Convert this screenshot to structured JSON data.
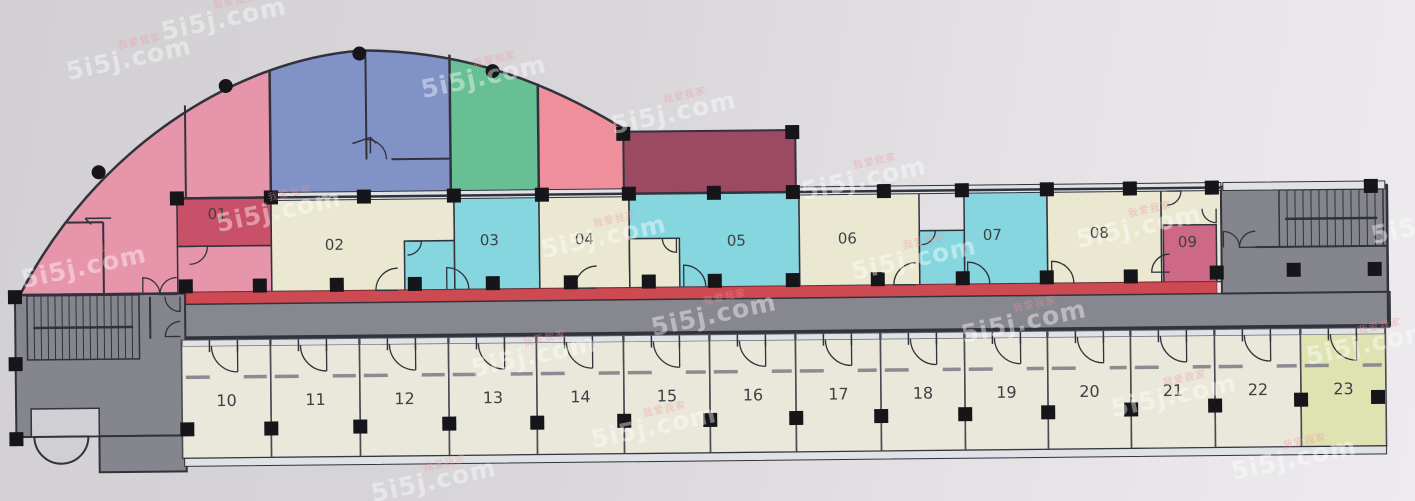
{
  "watermark": {
    "brand": "5i5j.com",
    "cn": "我爱我家",
    "positions": [
      [
        20,
        252
      ],
      [
        65,
        44
      ],
      [
        160,
        4
      ],
      [
        215,
        196
      ],
      [
        420,
        62
      ],
      [
        610,
        98
      ],
      [
        540,
        222
      ],
      [
        800,
        164
      ],
      [
        850,
        244
      ],
      [
        1075,
        212
      ],
      [
        1370,
        208
      ],
      [
        650,
        300
      ],
      [
        960,
        307
      ],
      [
        1305,
        329
      ],
      [
        470,
        341
      ],
      [
        590,
        412
      ],
      [
        1110,
        381
      ],
      [
        370,
        466
      ],
      [
        1230,
        444
      ]
    ]
  },
  "plan": {
    "palette": {
      "pink": "#e795ab",
      "red": "#c85068",
      "blue": "#8092c6",
      "green": "#67c093",
      "salmon": "#ee8f9b",
      "maroon": "#9c4a62",
      "cream": "#eae8d0",
      "cyan": "#85d6de",
      "deepPink": "#cd6886",
      "redStrip": "#ce4a52",
      "gray": "#87878f",
      "blockGray": "#85858e",
      "roomFill": "#e9e8da",
      "room23": "#dfe3b2",
      "window": "#dfe3e6",
      "wall": "#32323c",
      "column": "#15151a",
      "label": "#3f4046",
      "lightFill": "#d0d0d4"
    },
    "arc": {
      "path": "M20,288 L186,288 L186,193 L630,193 L630,131 C555,83 470,48 365,47 C235,55 95,145 20,288 Z",
      "bands": [
        {
          "x1": 20,
          "x2": 272,
          "fill": "pink"
        },
        {
          "x1": 272,
          "x2": 452,
          "fill": "blue"
        },
        {
          "x1": 452,
          "x2": 540,
          "fill": "green"
        },
        {
          "x1": 540,
          "x2": 630,
          "fill": "salmon"
        }
      ],
      "dots": [
        [
          100,
          166
        ],
        [
          228,
          81
        ],
        [
          362,
          50
        ],
        [
          495,
          69
        ]
      ]
    },
    "maroon_room": {
      "x": 625,
      "y": 131,
      "w": 172,
      "h": 62,
      "fill": "maroon"
    },
    "upper_rooms": [
      {
        "label": "",
        "x": 178,
        "y": 241,
        "w": 94,
        "h": 46,
        "fill": "pink"
      },
      {
        "label": "01",
        "x": 178,
        "y": 193,
        "w": 94,
        "h": 48,
        "fill": "red",
        "lx": 218,
        "ly": 214
      },
      {
        "label": "02",
        "x": 272,
        "y": 193,
        "w": 183,
        "h": 94,
        "fill": "cream",
        "lx": 335,
        "ly": 246
      },
      {
        "label": "",
        "x": 405,
        "y": 238,
        "w": 50,
        "h": 49,
        "fill": "cyan"
      },
      {
        "label": "03",
        "x": 455,
        "y": 193,
        "w": 85,
        "h": 94,
        "fill": "cyan",
        "lx": 490,
        "ly": 243
      },
      {
        "label": "04",
        "x": 540,
        "y": 193,
        "w": 90,
        "h": 94,
        "fill": "cream",
        "lx": 585,
        "ly": 243
      },
      {
        "label": "05",
        "x": 630,
        "y": 193,
        "w": 170,
        "h": 94,
        "fill": "cyan",
        "lx": 737,
        "ly": 246
      },
      {
        "label": "",
        "x": 630,
        "y": 238,
        "w": 50,
        "h": 49,
        "fill": "cream"
      },
      {
        "label": "06",
        "x": 800,
        "y": 193,
        "w": 120,
        "h": 94,
        "fill": "cream",
        "lx": 848,
        "ly": 245
      },
      {
        "label": "",
        "x": 920,
        "y": 233,
        "w": 45,
        "h": 54,
        "fill": "cyan"
      },
      {
        "label": "07",
        "x": 965,
        "y": 193,
        "w": 83,
        "h": 94,
        "fill": "cyan",
        "lx": 993,
        "ly": 243
      },
      {
        "label": "08",
        "x": 1048,
        "y": 193,
        "w": 114,
        "h": 94,
        "fill": "cream",
        "lx": 1100,
        "ly": 242
      },
      {
        "label": "",
        "x": 1162,
        "y": 193,
        "w": 60,
        "h": 94,
        "fill": "cream"
      },
      {
        "label": "09",
        "x": 1164,
        "y": 230,
        "w": 53,
        "h": 57,
        "fill": "deepPink",
        "lx": 1188,
        "ly": 252
      }
    ],
    "lower_rooms": {
      "boundaries": [
        181,
        270,
        359,
        448,
        536,
        623,
        709,
        795,
        880,
        964,
        1047,
        1130,
        1214,
        1300,
        1385
      ],
      "labels": [
        "10",
        "11",
        "12",
        "13",
        "14",
        "15",
        "16",
        "17",
        "18",
        "19",
        "20",
        "21",
        "22",
        "23"
      ],
      "y": 335,
      "h": 118,
      "label_y": 401
    },
    "red_strip": {
      "x": 186,
      "y": 287,
      "w": 1031,
      "h": 12
    },
    "corridor": {
      "x": 150,
      "y": 299,
      "w": 1240,
      "h": 34
    },
    "left_block": {
      "main": [
        15,
        288,
        170,
        142
      ],
      "tab": [
        98,
        430,
        87,
        36
      ],
      "alcove": [
        30,
        402,
        68,
        28
      ],
      "semi_cx": 60,
      "semi_cy": 430,
      "semi_r": 27
    },
    "vestibule": {
      "x": 1222,
      "y": 192,
      "w": 166,
      "h": 107
    },
    "stairs": [
      {
        "x1": 27,
        "y1": 289,
        "x2": 139,
        "y2": 353,
        "step": 7,
        "rail_y": 321
      },
      {
        "x1": 1280,
        "y1": 196,
        "x2": 1384,
        "y2": 253,
        "step": 8,
        "rail_y": 225
      }
    ],
    "window_bands": [
      {
        "x1": 272,
        "x2": 630,
        "y": 188,
        "h": 8
      },
      {
        "x1": 800,
        "x2": 1222,
        "y": 188,
        "h": 8
      },
      {
        "x1": 1224,
        "x2": 1386,
        "y": 188,
        "h": 8
      },
      {
        "x1": 183,
        "x2": 1385,
        "y": 453,
        "h": 8
      }
    ],
    "walls": [
      [
        187,
        100,
        187,
        193,
        2
      ],
      [
        104,
        216,
        104,
        288,
        2
      ],
      [
        68,
        216,
        104,
        216,
        2
      ],
      [
        272,
        66,
        272,
        193,
        2.5
      ],
      [
        368,
        53,
        368,
        156,
        2
      ],
      [
        393,
        156,
        452,
        156,
        2
      ],
      [
        452,
        52,
        452,
        193,
        2.5
      ],
      [
        540,
        82,
        540,
        193,
        2.5
      ],
      [
        178,
        193,
        1222,
        193,
        2.5
      ],
      [
        20,
        288,
        186,
        288,
        2.5
      ],
      [
        150,
        291,
        150,
        333,
        2
      ],
      [
        1256,
        253,
        1388,
        253,
        2
      ],
      [
        1388,
        192,
        1388,
        333,
        2.5
      ]
    ],
    "doors": [
      {
        "x": 143,
        "y": 289,
        "r": 17,
        "a0": 270,
        "a1": 360
      },
      {
        "x": 177,
        "y": 289,
        "r": 17,
        "a0": 180,
        "a1": 270
      },
      {
        "x": 180,
        "y": 291,
        "r": 15,
        "a0": 90,
        "a1": 180
      },
      {
        "x": 180,
        "y": 331,
        "r": 15,
        "a0": 180,
        "a1": 270
      },
      {
        "x": 190,
        "y": 241,
        "r": 18,
        "a0": 0,
        "a1": 90
      },
      {
        "x": 398,
        "y": 287,
        "r": 22,
        "a0": 180,
        "a1": 270
      },
      {
        "x": 408,
        "y": 238,
        "r": 14,
        "a0": 0,
        "a1": 90
      },
      {
        "x": 447,
        "y": 287,
        "r": 22,
        "a0": 270,
        "a1": 360
      },
      {
        "x": 597,
        "y": 287,
        "r": 22,
        "a0": 180,
        "a1": 270
      },
      {
        "x": 684,
        "y": 287,
        "r": 22,
        "a0": 270,
        "a1": 360
      },
      {
        "x": 677,
        "y": 238,
        "r": 14,
        "a0": 90,
        "a1": 180
      },
      {
        "x": 916,
        "y": 287,
        "r": 22,
        "a0": 180,
        "a1": 270
      },
      {
        "x": 922,
        "y": 233,
        "r": 14,
        "a0": 0,
        "a1": 90
      },
      {
        "x": 968,
        "y": 287,
        "r": 22,
        "a0": 270,
        "a1": 360
      },
      {
        "x": 1052,
        "y": 287,
        "r": 22,
        "a0": 270,
        "a1": 360
      },
      {
        "x": 1170,
        "y": 277,
        "r": 18,
        "a0": 180,
        "a1": 270
      },
      {
        "x": 1168,
        "y": 196,
        "r": 14,
        "a0": 0,
        "a1": 90
      },
      {
        "x": 1217,
        "y": 214,
        "r": 14,
        "a0": 90,
        "a1": 180
      },
      {
        "x": 368,
        "y": 156,
        "r": 20,
        "a0": 270,
        "a1": 360
      },
      {
        "x": 1224,
        "y": 253,
        "r": 16,
        "a0": 270,
        "a1": 360
      },
      {
        "x": 1256,
        "y": 253,
        "r": 16,
        "a0": 180,
        "a1": 270
      }
    ],
    "arrows": [
      {
        "x1": 112,
        "y1": 212,
        "x2": 86,
        "y2": 212
      },
      {
        "x1": 372,
        "y1": 150,
        "x2": 372,
        "y2": 134
      }
    ],
    "columns": [
      [
        178,
        193
      ],
      [
        272,
        193
      ],
      [
        365,
        193
      ],
      [
        455,
        193
      ],
      [
        543,
        193
      ],
      [
        630,
        193
      ],
      [
        715,
        193
      ],
      [
        794,
        193
      ],
      [
        885,
        193
      ],
      [
        963,
        193
      ],
      [
        1048,
        193
      ],
      [
        1131,
        193
      ],
      [
        1213,
        193
      ],
      [
        1372,
        193
      ],
      [
        625,
        133
      ],
      [
        794,
        133
      ],
      [
        186,
        281
      ],
      [
        260,
        281
      ],
      [
        337,
        281
      ],
      [
        415,
        281
      ],
      [
        493,
        281
      ],
      [
        571,
        281
      ],
      [
        649,
        281
      ],
      [
        715,
        281
      ],
      [
        793,
        281
      ],
      [
        878,
        281
      ],
      [
        963,
        281
      ],
      [
        1047,
        281
      ],
      [
        1131,
        281
      ],
      [
        1217,
        278
      ],
      [
        1294,
        276
      ],
      [
        1375,
        276
      ],
      [
        186,
        424
      ],
      [
        270,
        424
      ],
      [
        359,
        423
      ],
      [
        448,
        421
      ],
      [
        536,
        421
      ],
      [
        623,
        420
      ],
      [
        709,
        420
      ],
      [
        795,
        419
      ],
      [
        880,
        418
      ],
      [
        964,
        417
      ],
      [
        1047,
        416
      ],
      [
        1130,
        414
      ],
      [
        1214,
        411
      ],
      [
        1300,
        406
      ],
      [
        1377,
        404
      ],
      [
        15,
        290
      ],
      [
        15,
        357
      ],
      [
        15,
        432
      ]
    ]
  }
}
